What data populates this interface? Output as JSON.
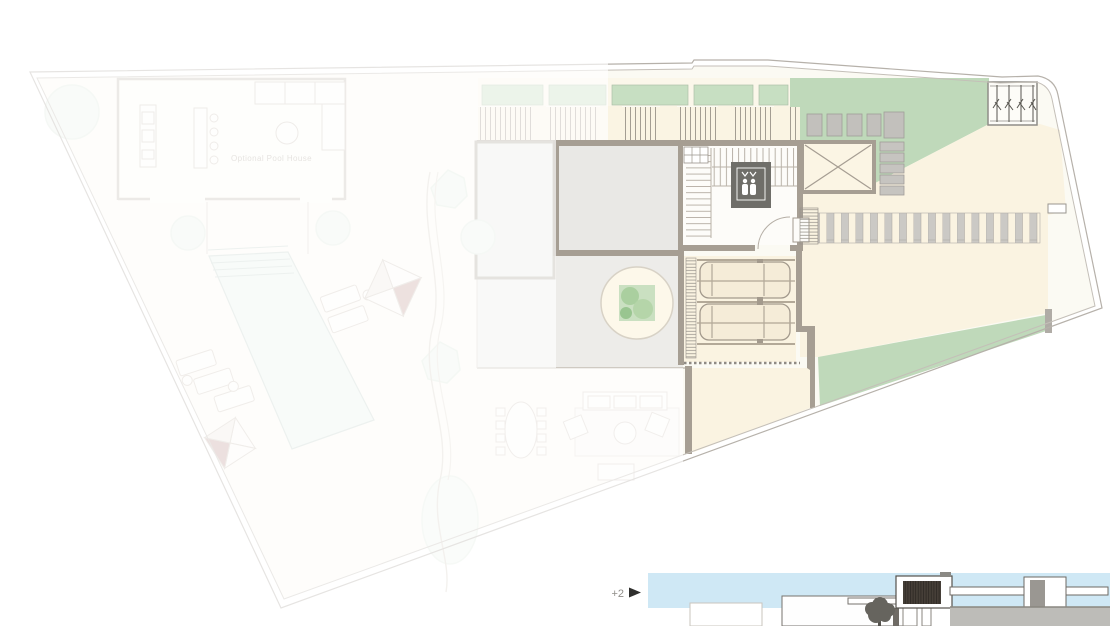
{
  "plan": {
    "labels": {
      "pool_house": "Optional Pool House"
    },
    "palette": {
      "property_fill": "#fbfaf3",
      "lawn_green": "#bfd9ba",
      "planter_green": "#c7dfc2",
      "driveway_cream": "#faf3e1",
      "wall_taupe": "#a69e93",
      "room_gray": "#e9e8e5",
      "terrace_gray": "#edece9",
      "pool_blue": "#e9f2ee",
      "paving_gray": "#cbc9c5",
      "elevator_gray": "#6f6e69",
      "umbrella_red": "#c9a8a2",
      "boundary_line": "#b6b1aa",
      "tree_canopy": "#a6cd9b"
    }
  },
  "elevation": {
    "level_label": "+2",
    "sky_color": "#cfe8f5",
    "wall_gray": "#bdbcb8",
    "window_dark": "#463f38"
  }
}
